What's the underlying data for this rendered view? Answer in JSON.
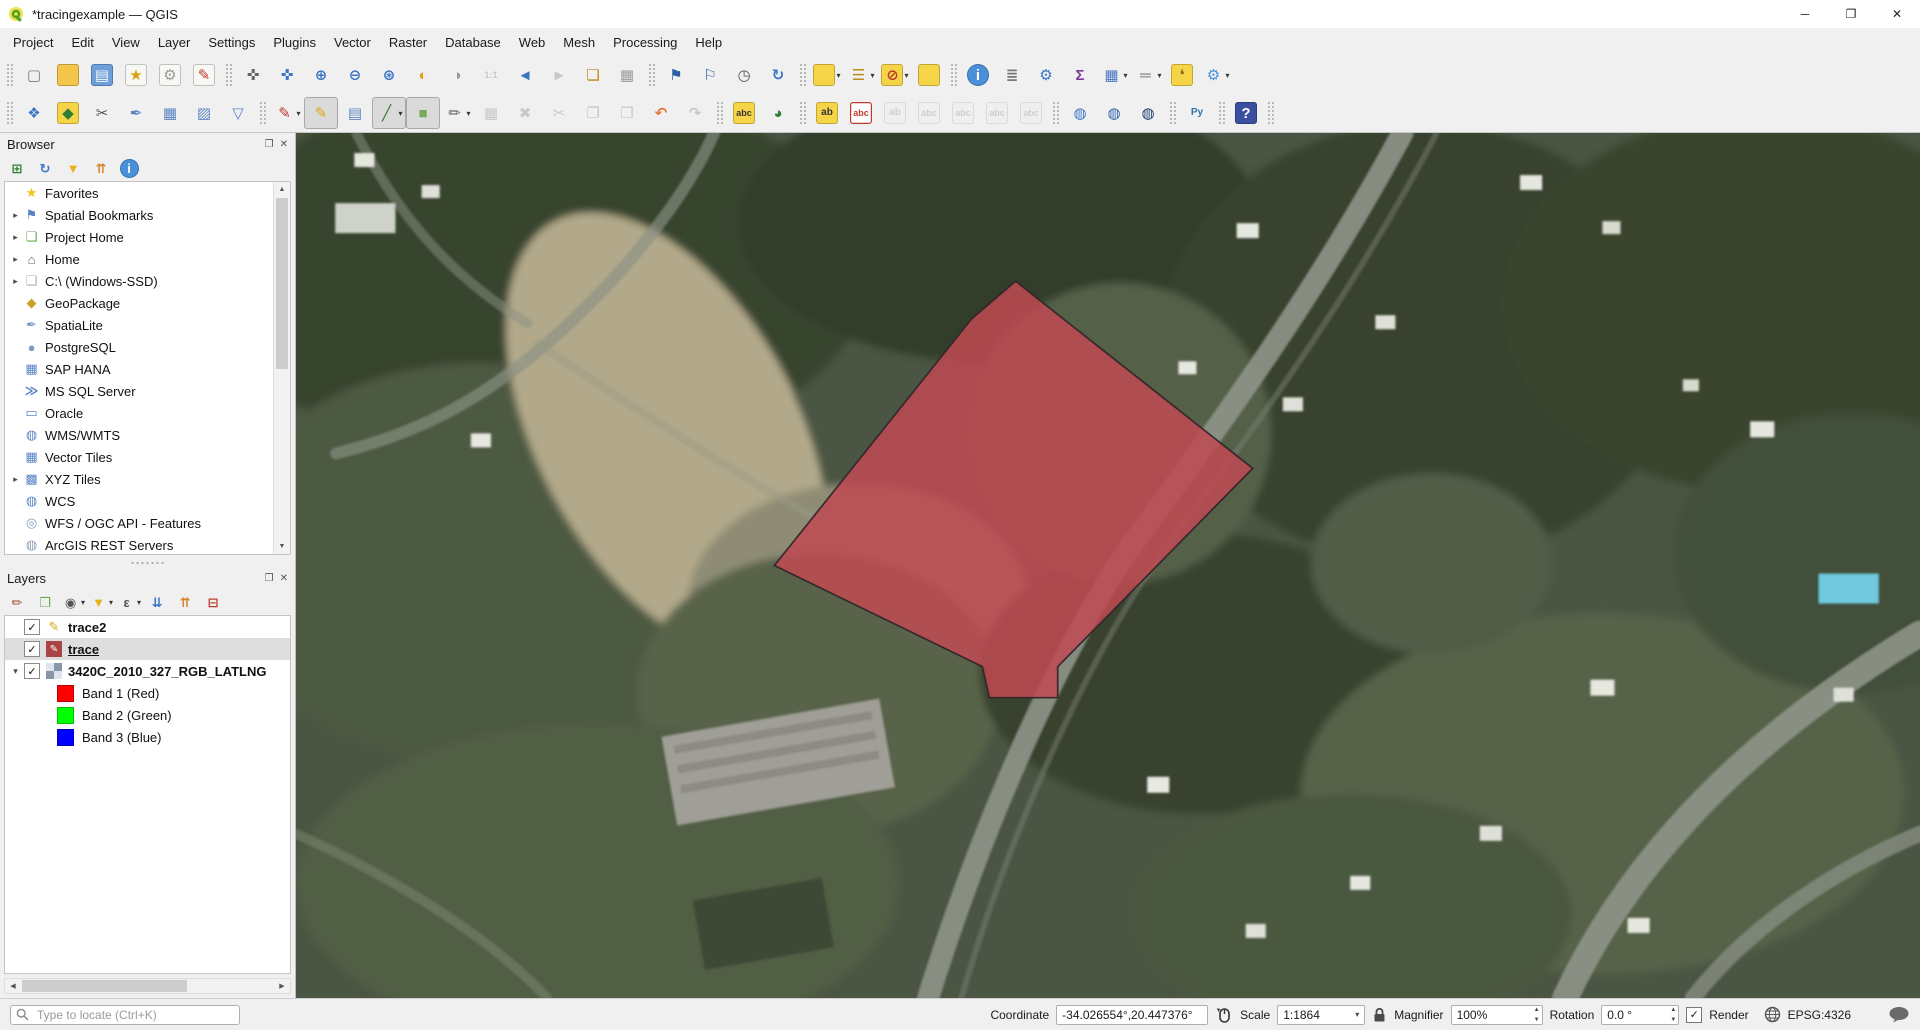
{
  "window": {
    "title": "*tracingexample — QGIS"
  },
  "icons": {
    "minimize": "─",
    "maximize": "❐",
    "close": "✕",
    "panel_float": "❐",
    "panel_close": "✕",
    "check": "✓",
    "dropdown": "▾",
    "expand_collapsed": "▸",
    "expand_expanded": "▾",
    "scroll_up": "▲",
    "scroll_down": "▼",
    "scroll_left": "◀",
    "scroll_right": "▶"
  },
  "menubar": {
    "items": [
      "Project",
      "Edit",
      "View",
      "Layer",
      "Settings",
      "Plugins",
      "Vector",
      "Raster",
      "Database",
      "Web",
      "Mesh",
      "Processing",
      "Help"
    ]
  },
  "toolbars": {
    "row1": [
      {
        "sep": true
      },
      {
        "n": "project-new",
        "g": "▢",
        "fg": "#777"
      },
      {
        "n": "project-open",
        "g": "",
        "bg": "#f3c64b"
      },
      {
        "n": "project-save",
        "g": "▤",
        "bg": "#6d9fd8",
        "fg": "#f4f7fb"
      },
      {
        "n": "new-print-layout",
        "g": "★",
        "bg": "#f7f7f3",
        "fg": "#d8a012"
      },
      {
        "n": "show-layout-manager",
        "g": "⚙",
        "bg": "#f7f7f3",
        "fg": "#9a9a9a"
      },
      {
        "n": "style-manager",
        "g": "✎",
        "bg": "#f7f7f3",
        "fg": "#c0392b"
      },
      {
        "sep": true
      },
      {
        "n": "pan-map",
        "g": "✜",
        "fg": "#666"
      },
      {
        "n": "pan-to-selection",
        "g": "✜",
        "fg": "#3a76c4"
      },
      {
        "n": "zoom-in",
        "g": "⊕",
        "fg": "#3a76c4"
      },
      {
        "n": "zoom-out",
        "g": "⊖",
        "fg": "#3a76c4"
      },
      {
        "n": "zoom-full-extent",
        "g": "⊛",
        "fg": "#3a76c4"
      },
      {
        "n": "zoom-to-selection",
        "g": "◐",
        "fg": "#d9a514"
      },
      {
        "n": "zoom-to-layer",
        "g": "◑",
        "fg": "#9a9a9a"
      },
      {
        "n": "zoom-native-resolution",
        "g": "1:1",
        "fg": "#888",
        "d": 1
      },
      {
        "n": "zoom-last",
        "g": "◄",
        "fg": "#3a76c4"
      },
      {
        "n": "zoom-next",
        "g": "►",
        "fg": "#888",
        "d": 1
      },
      {
        "n": "new-map-view",
        "g": "❏",
        "fg": "#b98c1a"
      },
      {
        "n": "new-3d-map-view",
        "g": "▦",
        "fg": "#9a9a9a"
      },
      {
        "sep": true
      },
      {
        "n": "new-spatial-bookmark",
        "g": "⚑",
        "fg": "#2b5fa5"
      },
      {
        "n": "show-spatial-bookmarks",
        "g": "⚐",
        "fg": "#2b5fa5"
      },
      {
        "n": "temporal-controller",
        "g": "◷",
        "fg": "#555"
      },
      {
        "n": "refresh-map",
        "g": "↻",
        "fg": "#3a76c4"
      },
      {
        "sep": true
      },
      {
        "n": "select-features",
        "g": "",
        "bg": "#f5d547",
        "dd": 1
      },
      {
        "n": "select-features-by-value",
        "g": "☰",
        "fg": "#b98c1a",
        "dd": 1
      },
      {
        "n": "deselect-features",
        "g": "⊘",
        "bg": "#f5d547",
        "fg": "#c0392b",
        "dd": 1
      },
      {
        "n": "select-all-features",
        "g": "",
        "bg": "#f5d547"
      },
      {
        "sep": true
      },
      {
        "n": "identify-features",
        "g": "i",
        "bg": "#4a90d9",
        "fg": "#fff",
        "round": 1
      },
      {
        "n": "statistical-summary",
        "g": "≣",
        "fg": "#777"
      },
      {
        "n": "processing-toolbox",
        "g": "⚙",
        "fg": "#3a76c4"
      },
      {
        "n": "show-statistics",
        "g": "Σ",
        "fg": "#7d3c98"
      },
      {
        "n": "open-attribute-table",
        "g": "▦",
        "fg": "#4a76c4",
        "dd": 1
      },
      {
        "n": "measure-line",
        "g": "═",
        "fg": "#777",
        "dd": 1
      },
      {
        "n": "map-tips",
        "g": "❛",
        "bg": "#f5d547",
        "fg": "#8a6d1a"
      },
      {
        "n": "run-feature-action",
        "g": "⚙",
        "fg": "#4a90d9",
        "dd": 1
      }
    ],
    "row2": [
      {
        "sep": true
      },
      {
        "n": "data-source-manager",
        "g": "❖",
        "fg": "#3a76c4"
      },
      {
        "n": "new-geopackage-layer",
        "g": "◆",
        "bg": "#f5d547",
        "fg": "#2e7d32"
      },
      {
        "n": "new-shapefile-layer",
        "g": "✂",
        "fg": "#555"
      },
      {
        "n": "new-spatialite-layer",
        "g": "✒",
        "fg": "#5b84c4"
      },
      {
        "n": "new-temporary-scratch-layer",
        "g": "▦",
        "fg": "#5b84c4"
      },
      {
        "n": "new-virtual-layer",
        "g": "▨",
        "fg": "#5b84c4"
      },
      {
        "n": "new-mesh-layer",
        "g": "▽",
        "fg": "#5b84c4"
      },
      {
        "sep": true
      },
      {
        "n": "current-edits",
        "g": "✎",
        "fg": "#c0392b",
        "dd": 1
      },
      {
        "n": "toggle-editing",
        "g": "✎",
        "fg": "#d9a514",
        "p": 1
      },
      {
        "n": "save-layer-edits",
        "g": "▤",
        "fg": "#5b84c4"
      },
      {
        "n": "digitize-with-segment",
        "g": "╱",
        "fg": "#2e7d32",
        "p": 1,
        "dd": 1
      },
      {
        "n": "add-polygon-feature",
        "g": "■",
        "fg": "#7aa95c",
        "p": 1
      },
      {
        "n": "vertex-tool",
        "g": "✏",
        "fg": "#666",
        "dd": 1
      },
      {
        "n": "modify-attributes",
        "g": "▦",
        "fg": "#888",
        "d": 1
      },
      {
        "n": "delete-selected",
        "g": "✖",
        "fg": "#888",
        "d": 1
      },
      {
        "n": "cut-features",
        "g": "✂",
        "fg": "#888",
        "d": 1
      },
      {
        "n": "copy-features",
        "g": "❐",
        "fg": "#888",
        "d": 1
      },
      {
        "n": "paste-features",
        "g": "❒",
        "fg": "#888",
        "d": 1
      },
      {
        "n": "undo",
        "g": "↶",
        "fg": "#e07b39"
      },
      {
        "n": "redo",
        "g": "↷",
        "fg": "#888",
        "d": 1
      },
      {
        "sep": true
      },
      {
        "n": "layer-labeling-options",
        "g": "abc",
        "bg": "#f5d547",
        "fg": "#333"
      },
      {
        "n": "layer-diagram-options",
        "g": "◕",
        "fg": "#2e7d32"
      },
      {
        "sep": true
      },
      {
        "n": "pin-labels",
        "g": "ab",
        "bg": "#f5d547",
        "fg": "#333"
      },
      {
        "n": "highlight-pinned-labels",
        "g": "abc",
        "bg": "#fff",
        "fg": "#c0392b",
        "outline": "#c0392b"
      },
      {
        "n": "pin-unpin-labels",
        "g": "ab",
        "bg": "#eee",
        "fg": "#999",
        "d": 1
      },
      {
        "n": "show-hide-labels",
        "g": "abc",
        "bg": "#eee",
        "fg": "#999",
        "d": 1
      },
      {
        "n": "move-label",
        "g": "abc",
        "bg": "#eee",
        "fg": "#999",
        "d": 1
      },
      {
        "n": "rotate-label",
        "g": "abc",
        "bg": "#eee",
        "fg": "#999",
        "d": 1
      },
      {
        "n": "change-label",
        "g": "abc",
        "bg": "#eee",
        "fg": "#999",
        "d": 1
      },
      {
        "sep": true
      },
      {
        "n": "add-web-service-layer",
        "g": "◍",
        "fg": "#3a76c4"
      },
      {
        "n": "search-web-services",
        "g": "◍",
        "fg": "#2b5fa5"
      },
      {
        "n": "metasearch-catalog",
        "g": "◍",
        "fg": "#1a3a6b"
      },
      {
        "sep": true
      },
      {
        "n": "python-console",
        "g": "Py",
        "fg": "#3674a9"
      },
      {
        "sep": true
      },
      {
        "n": "help-contents",
        "g": "?",
        "bg": "#3b4fa0",
        "fg": "#fff"
      },
      {
        "sep": true
      }
    ]
  },
  "browser": {
    "title": "Browser",
    "toolbar": [
      {
        "n": "browser-add-selected-layers",
        "g": "⊞",
        "fg": "#2e7d32"
      },
      {
        "n": "browser-refresh",
        "g": "↻",
        "fg": "#3a76c4"
      },
      {
        "n": "browser-filter",
        "g": "▼",
        "fg": "#e8b21a"
      },
      {
        "n": "browser-collapse-all",
        "g": "⇈",
        "fg": "#d4872a"
      },
      {
        "n": "browser-properties",
        "g": "i",
        "bg": "#4a90d9",
        "fg": "#fff",
        "round": 1
      }
    ],
    "items": [
      {
        "label": "Favorites",
        "g": "★",
        "fg": "#f0c419"
      },
      {
        "label": "Spatial Bookmarks",
        "g": "⚑",
        "fg": "#5b84c4",
        "exp": 1
      },
      {
        "label": "Project Home",
        "g": "❏",
        "fg": "#6aa84f",
        "exp": 1
      },
      {
        "label": "Home",
        "g": "⌂",
        "fg": "#666",
        "exp": 1
      },
      {
        "label": "C:\\ (Windows-SSD)",
        "g": "❏",
        "fg": "#b0b0b0",
        "exp": 1
      },
      {
        "label": "GeoPackage",
        "g": "◆",
        "fg": "#c9a227"
      },
      {
        "label": "SpatiaLite",
        "g": "✒",
        "fg": "#7d9cc0"
      },
      {
        "label": "PostgreSQL",
        "g": "●",
        "fg": "#7d9cc0"
      },
      {
        "label": "SAP HANA",
        "g": "▦",
        "fg": "#5b84c4"
      },
      {
        "label": "MS SQL Server",
        "g": "≫",
        "fg": "#5b84c4"
      },
      {
        "label": "Oracle",
        "g": "▭",
        "fg": "#5b84c4"
      },
      {
        "label": "WMS/WMTS",
        "g": "◍",
        "fg": "#5b84c4"
      },
      {
        "label": "Vector Tiles",
        "g": "▦",
        "fg": "#5b84c4"
      },
      {
        "label": "XYZ Tiles",
        "g": "▩",
        "fg": "#5b84c4",
        "exp": 1
      },
      {
        "label": "WCS",
        "g": "◍",
        "fg": "#5b84c4"
      },
      {
        "label": "WFS / OGC API - Features",
        "g": "◎",
        "fg": "#7d9cc0"
      },
      {
        "label": "ArcGIS REST Servers",
        "g": "◍",
        "fg": "#8aa0b8"
      }
    ]
  },
  "layers": {
    "title": "Layers",
    "toolbar": [
      {
        "n": "open-layer-styling-panel",
        "g": "✏",
        "fg": "#a0522d"
      },
      {
        "n": "add-group",
        "g": "❐",
        "fg": "#6aa84f"
      },
      {
        "n": "manage-map-themes",
        "g": "◉",
        "fg": "#555",
        "dd": 1
      },
      {
        "n": "filter-legend",
        "g": "▼",
        "fg": "#e8b21a",
        "dd": 1
      },
      {
        "n": "filter-by-expression",
        "g": "ε",
        "fg": "#555",
        "dd": 1
      },
      {
        "n": "expand-all-layers",
        "g": "⇊",
        "fg": "#3a76c4"
      },
      {
        "n": "collapse-all-layers",
        "g": "⇈",
        "fg": "#d4872a"
      },
      {
        "n": "remove-layer",
        "g": "⊟",
        "fg": "#c0392b"
      }
    ],
    "items": [
      {
        "label": "trace2",
        "type": "vector",
        "checked": true,
        "bold": true,
        "icon": "pencil"
      },
      {
        "label": "trace",
        "type": "vector",
        "checked": true,
        "bold": true,
        "underline": true,
        "selected": true,
        "icon": "red-fill-pencil"
      },
      {
        "label": "3420C_2010_327_RGB_LATLNG",
        "type": "raster",
        "checked": true,
        "bold": true,
        "expanded": true
      },
      {
        "label": "Band 1 (Red)",
        "type": "band",
        "color": "#ff0000"
      },
      {
        "label": "Band 2 (Green)",
        "type": "band",
        "color": "#00ff00"
      },
      {
        "label": "Band 3 (Blue)",
        "type": "band",
        "color": "#0000ff"
      }
    ]
  },
  "statusbar": {
    "locate_placeholder": "Type to locate (Ctrl+K)",
    "coordinate_label": "Coordinate",
    "coordinate_value": "-34.026554°,20.447376°",
    "scale_label": "Scale",
    "scale_value": "1:1864",
    "magnifier_label": "Magnifier",
    "magnifier_value": "100%",
    "rotation_label": "Rotation",
    "rotation_value": "0.0 °",
    "render_label": "Render",
    "crs": "EPSG:4326"
  },
  "map": {
    "polygon": {
      "points": "716,148 952,335 758,533 758,564 690,564 683,533 476,432 672,186",
      "fill": "#bf4a52",
      "fill_opacity": 0.85,
      "stroke": "#33262b",
      "stroke_width": 1.6
    }
  }
}
